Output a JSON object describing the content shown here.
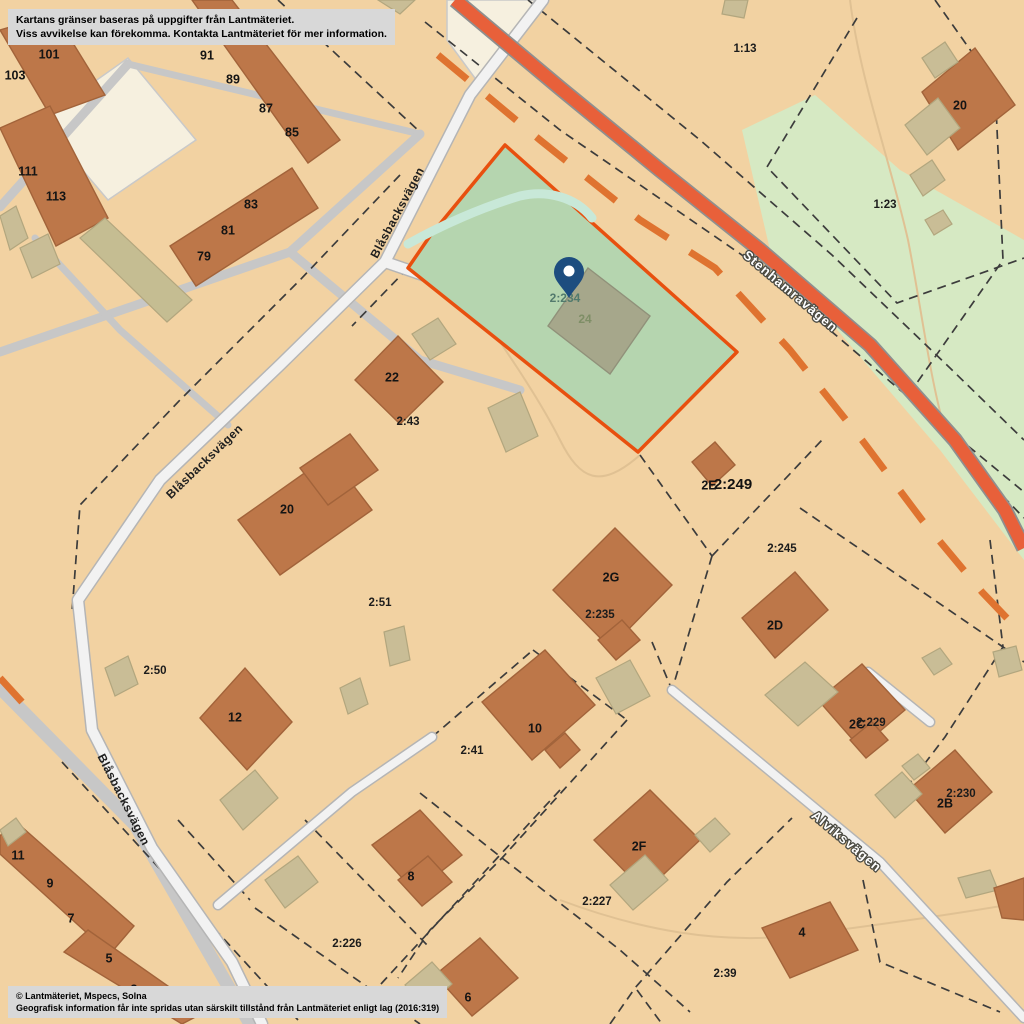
{
  "disclaimer": {
    "line1": "Kartans gränser baseras på uppgifter från Lantmäteriet.",
    "line2": "Viss avvikelse kan förekomma. Kontakta Lantmäteriet för mer information."
  },
  "copyright": {
    "line1": "© Lantmäteriet, Mspecs, Solna",
    "line2": "Geografisk information får inte spridas utan särskilt tillstånd från Lantmäteriet enligt lag (2016:319)"
  },
  "selected_property": {
    "designation": "2:234",
    "house_number": "24",
    "marker": "map-pin",
    "fill_color": "#b5d5af",
    "border_color": "#e8500f",
    "pin_color": "#1d4d7f"
  },
  "colors": {
    "background": "#f2d2a2",
    "building": "#bd7749",
    "outbuilding": "#c9bd96",
    "road_major": "#e8603a",
    "road_minor": "#f2f2f2",
    "green_area": "#d6e9c3",
    "water": "#c8e8d8"
  },
  "map_labels": [
    {
      "name": "house-number-103",
      "text": "103",
      "x": 15,
      "y": 76,
      "cls": "house"
    },
    {
      "name": "house-number-101",
      "text": "101",
      "x": 49,
      "y": 55,
      "cls": "house"
    },
    {
      "name": "house-number-91",
      "text": "91",
      "x": 207,
      "y": 56,
      "cls": "house"
    },
    {
      "name": "house-number-89",
      "text": "89",
      "x": 233,
      "y": 80,
      "cls": "house"
    },
    {
      "name": "house-number-87",
      "text": "87",
      "x": 266,
      "y": 109,
      "cls": "house"
    },
    {
      "name": "house-number-85",
      "text": "85",
      "x": 292,
      "y": 133,
      "cls": "house"
    },
    {
      "name": "house-number-111",
      "text": "111",
      "x": 28,
      "y": 172,
      "cls": "house"
    },
    {
      "name": "house-number-113",
      "text": "113",
      "x": 56,
      "y": 197,
      "cls": "house"
    },
    {
      "name": "house-number-83",
      "text": "83",
      "x": 251,
      "y": 205,
      "cls": "house"
    },
    {
      "name": "house-number-81",
      "text": "81",
      "x": 228,
      "y": 231,
      "cls": "house"
    },
    {
      "name": "house-number-79",
      "text": "79",
      "x": 204,
      "y": 257,
      "cls": "house"
    },
    {
      "name": "parcel-1-13",
      "text": "1:13",
      "x": 745,
      "y": 49,
      "cls": "parcel"
    },
    {
      "name": "house-number-20-ne",
      "text": "20",
      "x": 960,
      "y": 106,
      "cls": "house"
    },
    {
      "name": "parcel-1-23",
      "text": "1:23",
      "x": 885,
      "y": 205,
      "cls": "parcel"
    },
    {
      "name": "house-number-22",
      "text": "22",
      "x": 392,
      "y": 378,
      "cls": "house"
    },
    {
      "name": "parcel-2-43",
      "text": "2:43",
      "x": 408,
      "y": 422,
      "cls": "parcel"
    },
    {
      "name": "house-number-20-mid",
      "text": "20",
      "x": 287,
      "y": 510,
      "cls": "house"
    },
    {
      "name": "parcel-2-51",
      "text": "2:51",
      "x": 380,
      "y": 603,
      "cls": "parcel"
    },
    {
      "name": "parcel-2-50",
      "text": "2:50",
      "x": 155,
      "y": 671,
      "cls": "parcel"
    },
    {
      "name": "house-number-12",
      "text": "12",
      "x": 235,
      "y": 718,
      "cls": "house"
    },
    {
      "name": "parcel-2-41",
      "text": "2:41",
      "x": 472,
      "y": 751,
      "cls": "parcel"
    },
    {
      "name": "house-number-10",
      "text": "10",
      "x": 535,
      "y": 729,
      "cls": "house"
    },
    {
      "name": "house-number-2E",
      "text": "2E",
      "x": 709,
      "y": 486,
      "cls": "house"
    },
    {
      "name": "parcel-2-249",
      "text": "2:249",
      "x": 733,
      "y": 485,
      "cls": "large"
    },
    {
      "name": "parcel-2-245",
      "text": "2:245",
      "x": 782,
      "y": 549,
      "cls": "parcel"
    },
    {
      "name": "house-number-2G",
      "text": "2G",
      "x": 611,
      "y": 578,
      "cls": "house"
    },
    {
      "name": "parcel-2-235",
      "text": "2:235",
      "x": 600,
      "y": 615,
      "cls": "parcel"
    },
    {
      "name": "house-number-2D",
      "text": "2D",
      "x": 775,
      "y": 626,
      "cls": "house"
    },
    {
      "name": "house-number-2C",
      "text": "2C",
      "x": 857,
      "y": 725,
      "cls": "house"
    },
    {
      "name": "parcel-2-229",
      "text": "2:229",
      "x": 871,
      "y": 723,
      "cls": "parcel"
    },
    {
      "name": "house-number-2B",
      "text": "2B",
      "x": 945,
      "y": 804,
      "cls": "house"
    },
    {
      "name": "parcel-2-230",
      "text": "2:230",
      "x": 961,
      "y": 794,
      "cls": "parcel"
    },
    {
      "name": "house-number-11",
      "text": "11",
      "x": 18,
      "y": 856,
      "cls": "house"
    },
    {
      "name": "house-number-9",
      "text": "9",
      "x": 50,
      "y": 884,
      "cls": "house"
    },
    {
      "name": "house-number-7",
      "text": "7",
      "x": 71,
      "y": 919,
      "cls": "house"
    },
    {
      "name": "house-number-5",
      "text": "5",
      "x": 109,
      "y": 959,
      "cls": "house"
    },
    {
      "name": "house-number-3",
      "text": "3",
      "x": 134,
      "y": 990,
      "cls": "house"
    },
    {
      "name": "house-number-8",
      "text": "8",
      "x": 411,
      "y": 877,
      "cls": "house"
    },
    {
      "name": "parcel-2-226",
      "text": "2:226",
      "x": 347,
      "y": 944,
      "cls": "parcel"
    },
    {
      "name": "house-number-6",
      "text": "6",
      "x": 468,
      "y": 998,
      "cls": "house"
    },
    {
      "name": "parcel-2-227",
      "text": "2:227",
      "x": 597,
      "y": 902,
      "cls": "parcel"
    },
    {
      "name": "house-number-2F",
      "text": "2F",
      "x": 639,
      "y": 847,
      "cls": "house"
    },
    {
      "name": "house-number-4",
      "text": "4",
      "x": 802,
      "y": 933,
      "cls": "house"
    },
    {
      "name": "parcel-2-39",
      "text": "2:39",
      "x": 725,
      "y": 974,
      "cls": "parcel"
    },
    {
      "name": "selected-parcel-designation",
      "text": "2:234",
      "x": 565,
      "y": 299,
      "cls": "parcel-sel"
    },
    {
      "name": "selected-house-number",
      "text": "24",
      "x": 585,
      "y": 320,
      "cls": "house-sel"
    },
    {
      "name": "street-blasbacksvagen-upper",
      "text": "Blåsbacksvägen",
      "x": 398,
      "y": 213,
      "cls": "street-dark",
      "rot": -62
    },
    {
      "name": "street-blasbacksvagen-middle",
      "text": "Blåsbacksvägen",
      "x": 205,
      "y": 462,
      "cls": "street-dark",
      "rot": -44
    },
    {
      "name": "street-blasbacksvagen-lower",
      "text": "Blåsbacksvägen",
      "x": 123,
      "y": 800,
      "cls": "street-dark",
      "rot": 63
    },
    {
      "name": "street-stenhamravagen",
      "text": "Stenhamravägen",
      "x": 790,
      "y": 292,
      "cls": "street-light",
      "rot": 40
    },
    {
      "name": "street-alviksvagen",
      "text": "Alviksvägen",
      "x": 846,
      "y": 842,
      "cls": "street-light",
      "rot": 40
    }
  ]
}
